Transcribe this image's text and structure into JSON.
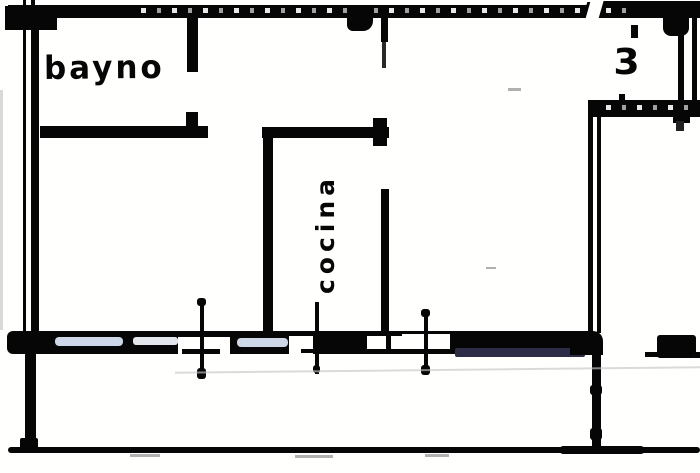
{
  "drawing": {
    "rooms": [
      {
        "id": "bathroom",
        "label": "bayno"
      },
      {
        "id": "kitchen",
        "label": "cocina"
      },
      {
        "id": "room-3",
        "label": "3"
      }
    ]
  },
  "colors": {
    "ink": "#0c0c0c",
    "paper": "#fbfaf8",
    "glass": "#c9d3e2",
    "glass2": "#dde1e7",
    "navy": "#30304a",
    "faint": "#c3c3c3"
  }
}
